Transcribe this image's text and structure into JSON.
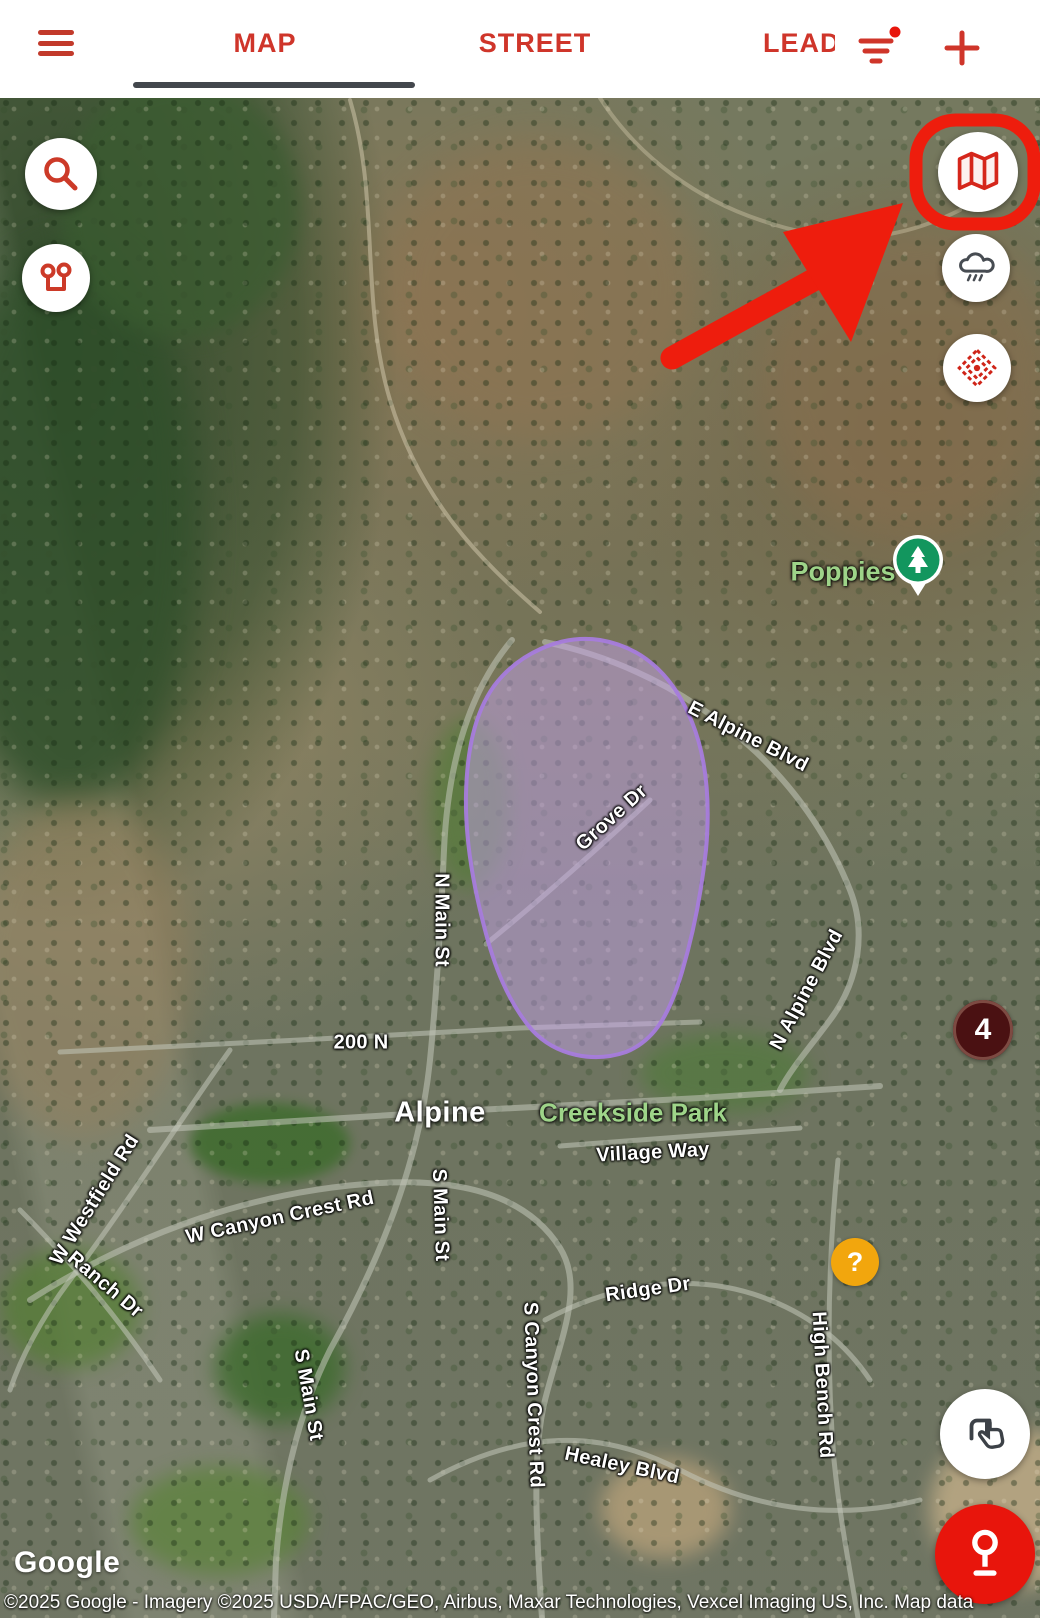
{
  "header": {
    "tabs": [
      {
        "label": "MAP",
        "active": true
      },
      {
        "label": "STREET",
        "active": false
      },
      {
        "label": "LEAD",
        "active": false
      }
    ],
    "filter_badge_visible": true,
    "accent_color": "#cf352a"
  },
  "map": {
    "city_label": "Alpine",
    "park_labels": [
      {
        "text": "Poppies"
      },
      {
        "text": "Creekside Park"
      }
    ],
    "road_labels": [
      {
        "text": "E Alpine Blvd"
      },
      {
        "text": "Grove Dr"
      },
      {
        "text": "N Main St"
      },
      {
        "text": "200 N"
      },
      {
        "text": "Village Way"
      },
      {
        "text": "N Alpine Blvd"
      },
      {
        "text": "W Westfield Rd"
      },
      {
        "text": "W Canyon Crest Rd"
      },
      {
        "text": "Ranch Dr"
      },
      {
        "text": "S Main St"
      },
      {
        "text": "S Canyon Crest Rd"
      },
      {
        "text": "Ridge Dr"
      },
      {
        "text": "High Bench Rd"
      },
      {
        "text": "Healey Blvd"
      },
      {
        "text": "S Main St"
      }
    ],
    "markers": {
      "cluster": {
        "count": "4",
        "color": "#4a1112"
      },
      "help": {
        "symbol": "?",
        "color": "#f2a60d"
      },
      "park_pin": {
        "icon": "tree-icon",
        "color": "#12965e"
      }
    },
    "territory": {
      "fill": "rgba(196,162,233,0.5)",
      "stroke": "rgba(167,124,220,0.95)"
    },
    "attribution": {
      "logo": "Google",
      "text": "©2025 Google - Imagery ©2025 USDA/FPAC/GEO, Airbus, Maxar Technologies, Vexcel Imaging US, Inc. Map data"
    }
  },
  "annotation": {
    "type": "highlight-ring-and-arrow",
    "target": "map-layers-button",
    "color": "#ee1d0d"
  }
}
